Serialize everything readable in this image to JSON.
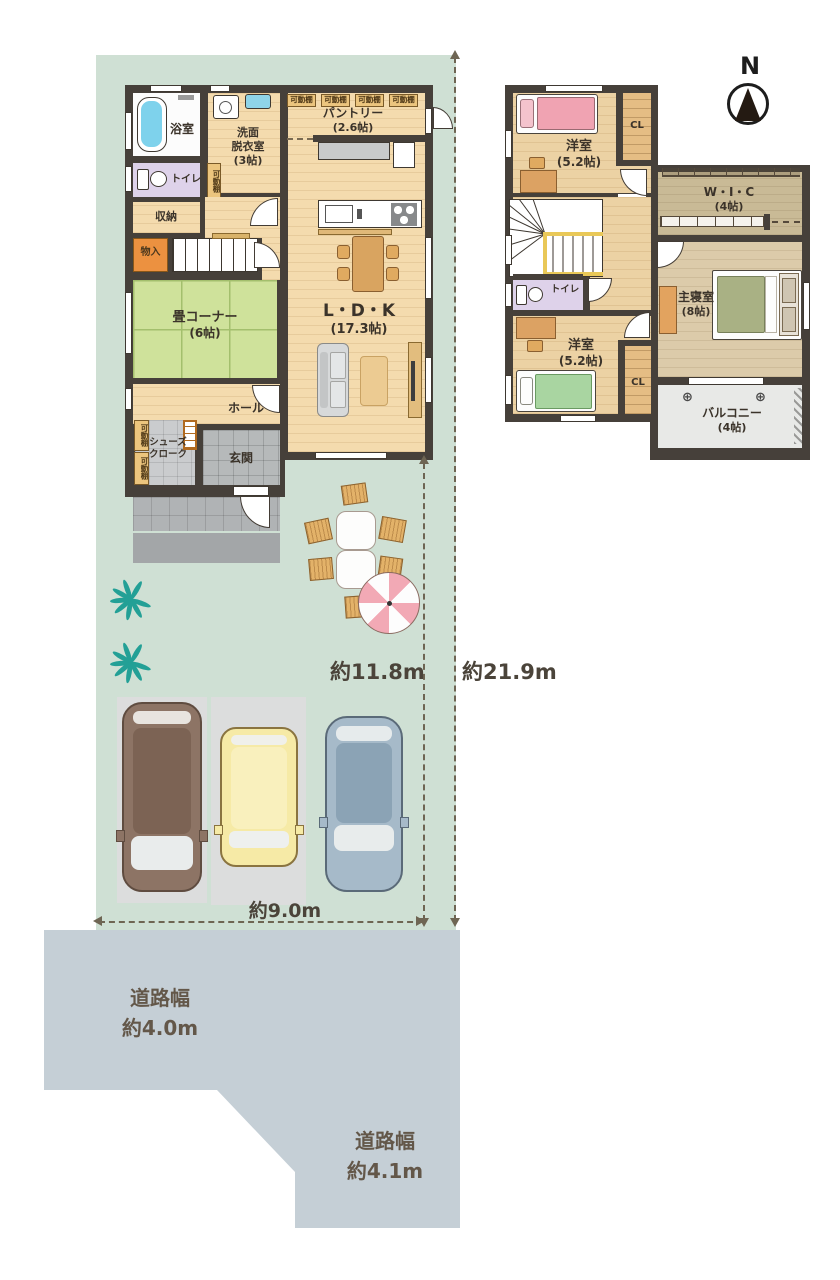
{
  "site": {
    "dim_width": "約9.0m",
    "dim_house_depth": "約11.8m",
    "dim_lot_depth": "約21.9m",
    "road_left_l1": "道路幅",
    "road_left_l2": "約4.0m",
    "road_bottom_l1": "道路幅",
    "road_bottom_l2": "約4.1m",
    "compass_n": "N",
    "drain": "⊕"
  },
  "f1": {
    "bath": "浴室",
    "wash1": "洗面",
    "wash2": "脱衣室",
    "wash_size": "(3帖)",
    "pantry": "パントリー",
    "pantry_size": "(2.6帖)",
    "shelf_tag": "可動棚",
    "toilet": "トイレ",
    "storage": "収納",
    "closet_small": "物入",
    "tatami": "畳コーナー",
    "tatami_size": "(6帖)",
    "ldk": "L・D・K",
    "ldk_size": "(17.3帖)",
    "hall": "ホール",
    "shoes1": "シューズ",
    "shoes2": "クローク",
    "entrance": "玄関"
  },
  "f2": {
    "bedroom_n": "洋室",
    "bedroom_n_size": "(5.2帖)",
    "cl": "CL",
    "wic": "W・I・C",
    "wic_size": "(4帖)",
    "toilet": "トイレ",
    "master": "主寝室",
    "master_size": "(8帖)",
    "bedroom_s": "洋室",
    "bedroom_s_size": "(5.2帖)",
    "balcony": "バルコニー",
    "balcony_size": "(4帖)"
  },
  "colors": {
    "lot_green": "#cfe0d4",
    "road_gray": "#c5cfd6",
    "wall": "#46403a",
    "wood_floor": "#f4dbae",
    "tatami_green": "#cfe29b",
    "toilet_lavender": "#ded2ea",
    "accent_orange": "#ec9140",
    "bed_pink": "#f0a3b2",
    "bed_green": "#a9d5a1",
    "bed_olive": "#a9b184",
    "car_brown": "#8d7465",
    "car_yellow": "#f6eaa6",
    "car_blue": "#a6bac9",
    "parasol_pink": "#f2a9b5",
    "palm_teal": "#23a096"
  }
}
